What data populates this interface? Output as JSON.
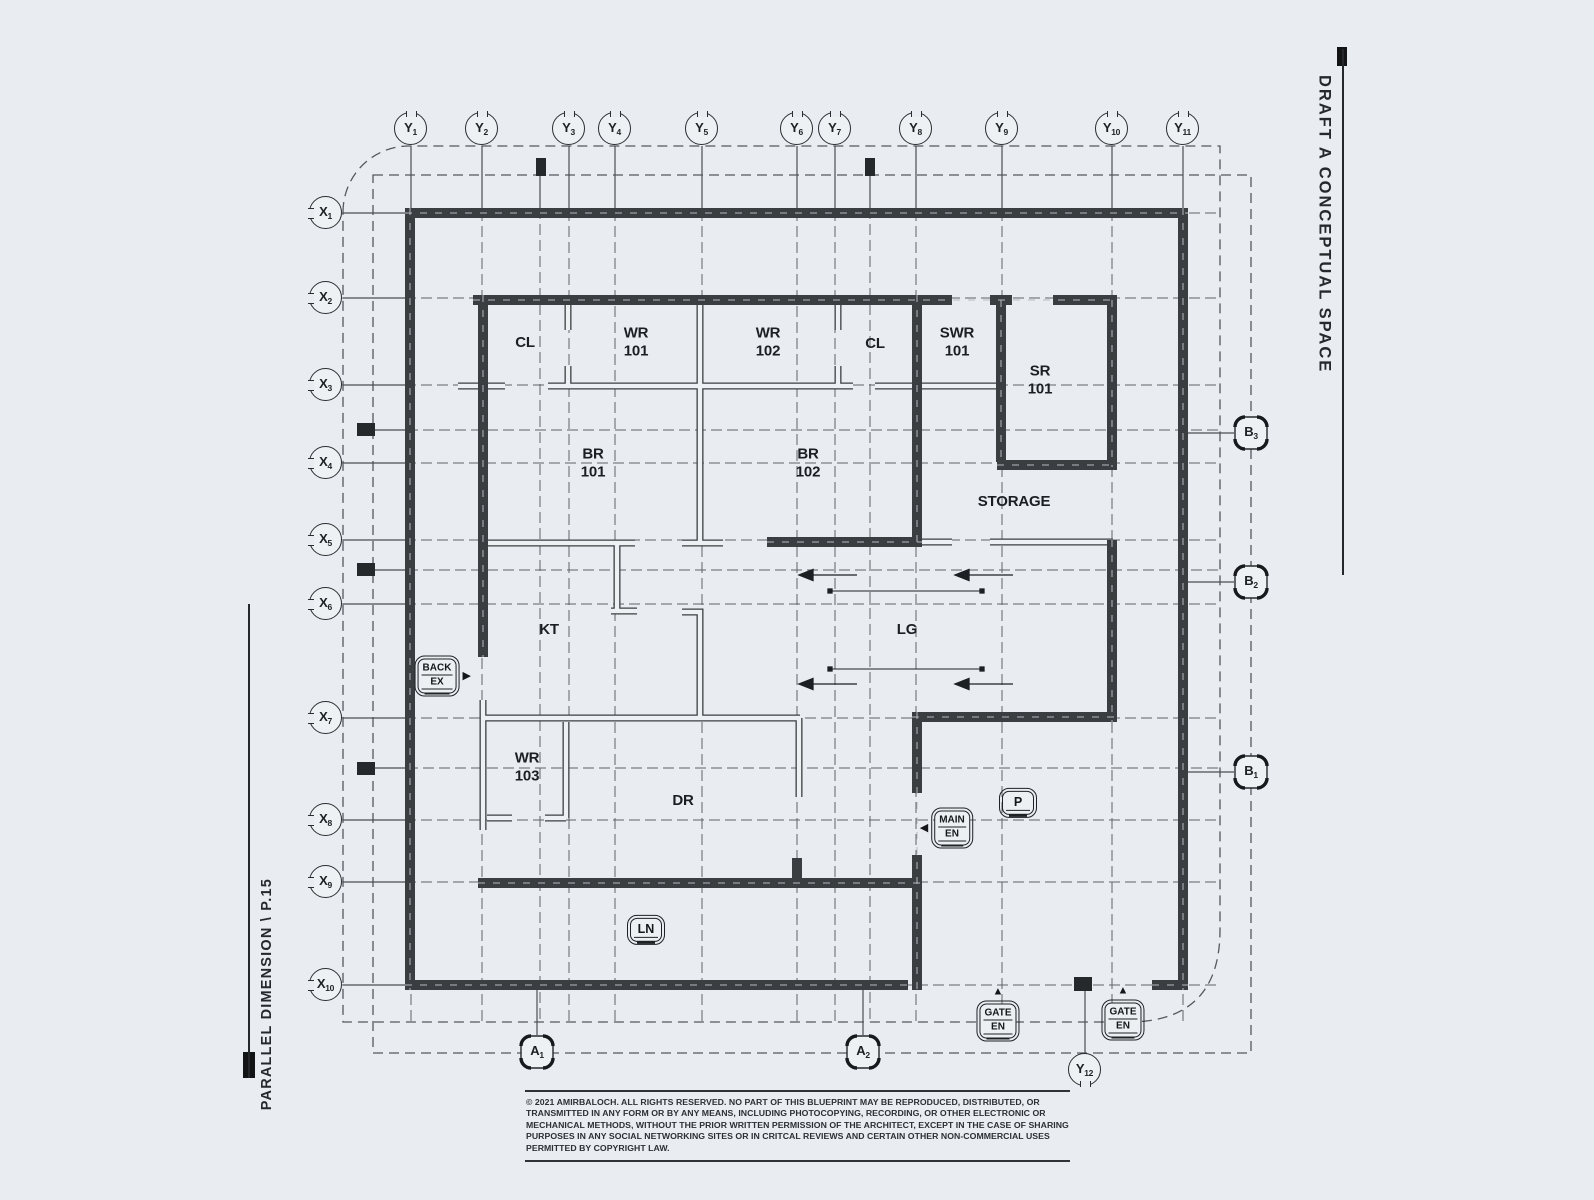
{
  "colors": {
    "background": "#e9edf1",
    "wall": "#3b3e41",
    "grid_line": "#5d6369",
    "boundary_dash": "#53595f",
    "text": "#1d2023"
  },
  "titles": {
    "right_vertical": "DRAFT A CONCEPTUAL SPACE",
    "left_vertical": "PARALLEL DIMENSION \\ P.15"
  },
  "copyright": "© 2021 AMIRBALOCH. ALL RIGHTS RESERVED. NO PART OF THIS BLUEPRINT MAY BE REPRODUCED, DISTRIBUTED, OR TRANSMITTED IN ANY FORM OR BY ANY MEANS, INCLUDING PHOTOCOPYING, RECORDING, OR OTHER ELECTRONIC OR MECHANICAL METHODS, WITHOUT THE PRIOR WRITTEN PERMISSION OF THE ARCHITECT, EXCEPT IN THE CASE OF SHARING PURPOSES IN ANY SOCIAL NETWORKING SITES OR IN CRITCAL REVIEWS AND CERTAIN OTHER NON-COMMERCIAL USES PERMITTED BY COPYRIGHT LAW.",
  "grid_markers": {
    "y_axis": [
      {
        "main": "Y",
        "sub": "1",
        "x": 411
      },
      {
        "main": "Y",
        "sub": "2",
        "x": 482
      },
      {
        "main": "Y",
        "sub": "3",
        "x": 569
      },
      {
        "main": "Y",
        "sub": "4",
        "x": 615
      },
      {
        "main": "Y",
        "sub": "5",
        "x": 702
      },
      {
        "main": "Y",
        "sub": "6",
        "x": 797
      },
      {
        "main": "Y",
        "sub": "7",
        "x": 835
      },
      {
        "main": "Y",
        "sub": "8",
        "x": 916
      },
      {
        "main": "Y",
        "sub": "9",
        "x": 1002
      },
      {
        "main": "Y",
        "sub": "10",
        "x": 1112
      },
      {
        "main": "Y",
        "sub": "11",
        "x": 1183
      }
    ],
    "x_axis": [
      {
        "main": "X",
        "sub": "1",
        "y": 213
      },
      {
        "main": "X",
        "sub": "2",
        "y": 298
      },
      {
        "main": "X",
        "sub": "3",
        "y": 385
      },
      {
        "main": "X",
        "sub": "4",
        "y": 463
      },
      {
        "main": "X",
        "sub": "5",
        "y": 540
      },
      {
        "main": "X",
        "sub": "6",
        "y": 604
      },
      {
        "main": "X",
        "sub": "7",
        "y": 718
      },
      {
        "main": "X",
        "sub": "8",
        "y": 820
      },
      {
        "main": "X",
        "sub": "9",
        "y": 882
      },
      {
        "main": "X",
        "sub": "10",
        "y": 985
      }
    ],
    "b_axis": [
      {
        "main": "B",
        "sub": "3",
        "y": 433
      },
      {
        "main": "B",
        "sub": "2",
        "y": 582
      },
      {
        "main": "B",
        "sub": "1",
        "y": 772
      }
    ],
    "a_axis": [
      {
        "main": "A",
        "sub": "1",
        "x": 537
      },
      {
        "main": "A",
        "sub": "2",
        "x": 863
      }
    ],
    "y12": {
      "main": "Y",
      "sub": "12",
      "x": 1085,
      "y": 1070
    }
  },
  "rooms": [
    {
      "id": "cl-1",
      "lines": [
        "CL"
      ],
      "x": 525,
      "y": 343
    },
    {
      "id": "wr-101",
      "lines": [
        "WR",
        "101"
      ],
      "x": 636,
      "y": 343
    },
    {
      "id": "wr-102",
      "lines": [
        "WR",
        "102"
      ],
      "x": 768,
      "y": 343
    },
    {
      "id": "cl-2",
      "lines": [
        "CL"
      ],
      "x": 875,
      "y": 344
    },
    {
      "id": "swr-101",
      "lines": [
        "SWR",
        "101"
      ],
      "x": 957,
      "y": 343
    },
    {
      "id": "sr-101",
      "lines": [
        "SR",
        "101"
      ],
      "x": 1040,
      "y": 381
    },
    {
      "id": "br-101",
      "lines": [
        "BR",
        "101"
      ],
      "x": 593,
      "y": 464
    },
    {
      "id": "br-102",
      "lines": [
        "BR",
        "102"
      ],
      "x": 808,
      "y": 464
    },
    {
      "id": "storage",
      "lines": [
        "STORAGE"
      ],
      "x": 1014,
      "y": 502
    },
    {
      "id": "kt",
      "lines": [
        "KT"
      ],
      "x": 549,
      "y": 630
    },
    {
      "id": "lg",
      "lines": [
        "LG"
      ],
      "x": 907,
      "y": 630
    },
    {
      "id": "wr-103",
      "lines": [
        "WR",
        "103"
      ],
      "x": 527,
      "y": 768
    },
    {
      "id": "dr",
      "lines": [
        "DR"
      ],
      "x": 683,
      "y": 801
    }
  ],
  "tags": [
    {
      "id": "back-exit",
      "lines": [
        "BACK",
        "EX"
      ],
      "x": 437,
      "y": 676,
      "arrow": "right"
    },
    {
      "id": "main-entrance",
      "lines": [
        "MAIN",
        "EN"
      ],
      "x": 952,
      "y": 828,
      "arrow": "left"
    },
    {
      "id": "parking",
      "lines": [
        "P"
      ],
      "x": 1018,
      "y": 803,
      "arrow": "",
      "big": true
    },
    {
      "id": "lawn",
      "lines": [
        "LN"
      ],
      "x": 646,
      "y": 930,
      "arrow": "",
      "big": true
    },
    {
      "id": "gate-entrance-1",
      "lines": [
        "GATE",
        "EN"
      ],
      "x": 998,
      "y": 1021,
      "arrow": "up"
    },
    {
      "id": "gate-entrance-2",
      "lines": [
        "GATE",
        "EN"
      ],
      "x": 1123,
      "y": 1020,
      "arrow": "up"
    }
  ]
}
